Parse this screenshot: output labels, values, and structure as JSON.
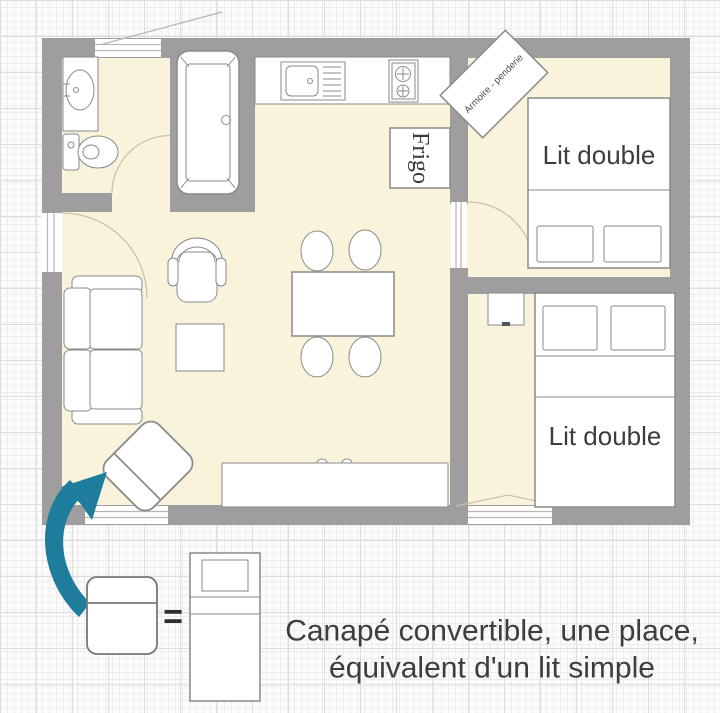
{
  "plan": {
    "bed_top_label": "Lit double",
    "bed_bottom_label": "Lit double",
    "fridge_label": "Frigo",
    "wardrobe_label": "Armoire - penderie"
  },
  "legend": {
    "equals_sign": "=",
    "caption_line1": "Canapé convertible, une place,",
    "caption_line2": "équivalent d'un lit simple"
  },
  "colors": {
    "wall": "#9e9e9e",
    "floor": "#faf3dc",
    "outline": "#8a8a8a",
    "text": "#3d3d3d",
    "arrow": "#1e7d9c",
    "arc": "#cbc1a6",
    "window_line": "#b5b5b5"
  }
}
